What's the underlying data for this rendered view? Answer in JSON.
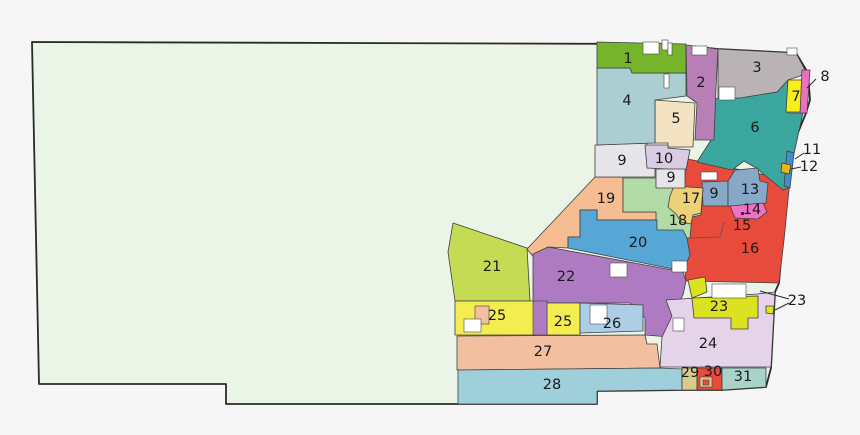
{
  "figure": {
    "width": 860,
    "height": 435,
    "background": "#f6f6f6"
  },
  "map": {
    "type": "choropleth-district-map",
    "district_stroke": "#3f3f3f",
    "label_color": "#1a1a1a",
    "white_fill": "#ffffff",
    "label_font_size": 14.5,
    "callout_font_size": 14.5,
    "base_region": {
      "fill": "#ebf5e7",
      "stroke": "#2a2a2a",
      "points": "32,42 660,44 688,46 718,49 796,53 808,73 810,100 806,113 795,140 790,172 788,190 783,235 779,283 775,292 771,368 766,387 722,390 682,390 597,391 597,404 226,404 226,384 39,384"
    },
    "districts": [
      {
        "num": "16",
        "color": "#e84b3c",
        "points": "683,158 790,180 784,240 779,283 686,281 683,250 688,224 681,192"
      },
      {
        "num": "6",
        "color": "#3aa69e",
        "points": "713,99 777,92 788,80 788,113 803,113 797,140 790,172 788,188 783,190 756,168 744,161 732,170 697,162 711,140"
      },
      {
        "num": "9",
        "color": "#87a9c7",
        "points": "702,182 728,181 728,206 703,206"
      },
      {
        "num": "13",
        "color": "#87a9c7",
        "points": "728,181 735,170 758,168 760,181 768,183 766,203 744,208 728,206"
      },
      {
        "num": "14",
        "color": "#f171c5",
        "points": "730,206 763,203 767,212 758,219 735,218"
      },
      {
        "num": "19",
        "color": "#f6bc92",
        "points": "595,177 623,177 623,212 657,212 657,220 597,220 597,210 580,210 580,237 568,237 568,248 548,247 540,265 527,249"
      },
      {
        "num": "18",
        "color": "#b2dba8",
        "points": "623,178 672,178 672,188 680,186 703,189 701,215 692,217 690,238 656,238 656,212 623,212"
      },
      {
        "num": "17",
        "color": "#edd179",
        "points": "674,186 703,188 701,213 693,215 691,224 681,222 676,214 668,207 670,196"
      },
      {
        "num": "9",
        "color": "#e7e5e9",
        "points": "595,145 647,143 647,168 655,168 655,177 595,177"
      },
      {
        "num": "5",
        "color": "#f3e3c3",
        "points": "655,100 695,103 693,147 668,147 668,143 655,143"
      },
      {
        "num": "10",
        "color": "#d8cbe2",
        "points": "645,145 668,145 668,148 690,150 686,170 647,168"
      },
      {
        "num": "9",
        "color": "#e7e5e9",
        "points": "656,169 685,169 685,188 656,188"
      },
      {
        "num": "4",
        "color": "#abced3",
        "points": "597,68 630,68 632,73 686,73 686,96 655,100 655,143 597,145"
      },
      {
        "num": "1",
        "color": "#76b42c",
        "points": "597,42 686,44 686,73 632,73 630,68 597,68"
      },
      {
        "num": "2",
        "color": "#b77fb5",
        "points": "686,45 718,49 716,88 714,140 695,140 697,103 687,96"
      },
      {
        "num": "3",
        "color": "#b9b3b5",
        "points": "718,49 796,53 806,72 800,76 788,80 777,92 740,98 718,98"
      },
      {
        "num": "7",
        "color": "#f8ef16",
        "points": "788,80 803,80 801,112 786,112"
      },
      {
        "num": "8",
        "color": "#ec6fc0",
        "points": "802,70 810,70 807,113 800,113"
      },
      {
        "num": "11",
        "color": "#3e8ecb",
        "points": "787,151 794,153 790,188 784,186"
      },
      {
        "num": "12",
        "color": "#f0b513",
        "points": "782,163 791,165 789,174 781,172"
      },
      {
        "num": "20",
        "color": "#56a6d6",
        "points": "580,210 597,210 597,220 657,220 657,230 683,230 687,238 690,255 683,271 568,248 568,237 580,237"
      },
      {
        "num": "22",
        "color": "#ae7bc3",
        "points": "548,247 683,272 686,281 683,295 672,316 670,337 645,335 645,318 630,303 533,303 533,254"
      },
      {
        "num": "21",
        "color": "#c5db54",
        "points": "453,223 527,248 530,301 455,301 448,252"
      },
      {
        "num": "24",
        "color": "#e5d3e9",
        "points": "666,300 757,294 775,292 771,367 660,367 662,337 672,316"
      },
      {
        "num": "23",
        "color": "#dce21f",
        "points": "688,280 705,277 707,292 692,298"
      },
      {
        "num": "23",
        "color": "#dce21f",
        "points": "692,298 758,296 758,318 748,318 748,329 731,329 731,318 694,318"
      },
      {
        "num": "23",
        "color": "#dce21f",
        "points": "766,306 774,306 773,314 766,313"
      },
      {
        "num": "25",
        "color": "#f4ed50",
        "points": "455,301 535,301 535,335 455,335"
      },
      {
        "num": "25",
        "color": "#f4ed50",
        "points": "547,303 580,303 580,335 547,335"
      },
      {
        "num": "26",
        "color": "#accfe7",
        "points": "580,303 643,305 643,331 580,333"
      },
      {
        "num": "27",
        "color": "#f2c0a0",
        "points": "457,336 645,335 647,344 657,344 660,368 457,370"
      },
      {
        "num": "28",
        "color": "#9ecfda",
        "points": "458,370 660,368 682,369 682,390 597,391 597,404 458,404"
      },
      {
        "num": "29",
        "color": "#d8cc8d",
        "points": "682,368 697,368 697,390 682,390"
      },
      {
        "num": "30",
        "color": "#e84b3c",
        "points": "697,368 722,368 722,390 697,390"
      },
      {
        "num": "31",
        "color": "#a8d3c8",
        "points": "722,368 766,368 766,387 722,390"
      }
    ],
    "color_patches": [
      {
        "x": 475,
        "y": 306,
        "w": 14,
        "h": 18,
        "color": "#f2c0a0"
      },
      {
        "x": 533,
        "y": 301,
        "w": 14,
        "h": 34,
        "color": "#ae7bc3"
      },
      {
        "x": 700,
        "y": 377,
        "w": 12,
        "h": 10,
        "color": "#d8cc8d"
      },
      {
        "x": 703,
        "y": 380,
        "w": 6,
        "h": 5,
        "color": "#e84b3c"
      }
    ],
    "white_patches": [
      {
        "x": 643,
        "y": 42,
        "w": 16,
        "h": 12
      },
      {
        "x": 662,
        "y": 40,
        "w": 6,
        "h": 10
      },
      {
        "x": 668,
        "y": 43,
        "w": 4,
        "h": 12
      },
      {
        "x": 692,
        "y": 46,
        "w": 15,
        "h": 9
      },
      {
        "x": 664,
        "y": 74,
        "w": 5,
        "h": 14
      },
      {
        "x": 719,
        "y": 87,
        "w": 16,
        "h": 13
      },
      {
        "x": 787,
        "y": 48,
        "w": 10,
        "h": 7
      },
      {
        "x": 701,
        "y": 172,
        "w": 16,
        "h": 8
      },
      {
        "x": 610,
        "y": 263,
        "w": 17,
        "h": 14
      },
      {
        "x": 672,
        "y": 261,
        "w": 15,
        "h": 11
      },
      {
        "x": 712,
        "y": 284,
        "w": 34,
        "h": 14
      },
      {
        "x": 673,
        "y": 318,
        "w": 11,
        "h": 13
      },
      {
        "x": 464,
        "y": 319,
        "w": 17,
        "h": 13
      },
      {
        "x": 590,
        "y": 305,
        "w": 17,
        "h": 19
      }
    ],
    "boundary_lines": [
      {
        "points": "688,238 720,237 724,222"
      }
    ],
    "marker_dot": {
      "x": 741,
      "y": 212,
      "size": 3
    },
    "labels": [
      {
        "text": "1",
        "x": 628,
        "y": 59
      },
      {
        "text": "2",
        "x": 701,
        "y": 83
      },
      {
        "text": "3",
        "x": 757,
        "y": 68
      },
      {
        "text": "4",
        "x": 627,
        "y": 101
      },
      {
        "text": "5",
        "x": 676,
        "y": 119
      },
      {
        "text": "6",
        "x": 755,
        "y": 128
      },
      {
        "text": "7",
        "x": 796,
        "y": 97
      },
      {
        "text": "9",
        "x": 622,
        "y": 161
      },
      {
        "text": "10",
        "x": 664,
        "y": 159
      },
      {
        "text": "9",
        "x": 671,
        "y": 178
      },
      {
        "text": "9",
        "x": 714,
        "y": 194
      },
      {
        "text": "13",
        "x": 750,
        "y": 190
      },
      {
        "text": "14",
        "x": 752,
        "y": 210
      },
      {
        "text": "15",
        "x": 742,
        "y": 226
      },
      {
        "text": "16",
        "x": 750,
        "y": 249
      },
      {
        "text": "17",
        "x": 691,
        "y": 199
      },
      {
        "text": "18",
        "x": 678,
        "y": 221
      },
      {
        "text": "19",
        "x": 606,
        "y": 199
      },
      {
        "text": "20",
        "x": 638,
        "y": 243
      },
      {
        "text": "21",
        "x": 492,
        "y": 267
      },
      {
        "text": "22",
        "x": 566,
        "y": 277
      },
      {
        "text": "23",
        "x": 719,
        "y": 307
      },
      {
        "text": "24",
        "x": 708,
        "y": 344
      },
      {
        "text": "25",
        "x": 497,
        "y": 316
      },
      {
        "text": "25",
        "x": 563,
        "y": 322
      },
      {
        "text": "26",
        "x": 612,
        "y": 324
      },
      {
        "text": "27",
        "x": 543,
        "y": 352
      },
      {
        "text": "28",
        "x": 552,
        "y": 385
      },
      {
        "text": "29",
        "x": 690,
        "y": 373
      },
      {
        "text": "30",
        "x": 713,
        "y": 372
      },
      {
        "text": "31",
        "x": 743,
        "y": 377
      }
    ],
    "callouts": [
      {
        "text": "8",
        "x": 825,
        "y": 77,
        "lines": [
          {
            "x1": 816,
            "y1": 79,
            "x2": 807,
            "y2": 88
          }
        ]
      },
      {
        "text": "11",
        "x": 812,
        "y": 150,
        "lines": [
          {
            "x1": 804,
            "y1": 153,
            "x2": 795,
            "y2": 159
          }
        ]
      },
      {
        "text": "12",
        "x": 809,
        "y": 167,
        "lines": [
          {
            "x1": 801,
            "y1": 167,
            "x2": 791,
            "y2": 169
          }
        ]
      },
      {
        "text": "23",
        "x": 797,
        "y": 301,
        "lines": [
          {
            "x1": 789,
            "y1": 299,
            "x2": 760,
            "y2": 291
          },
          {
            "x1": 789,
            "y1": 303,
            "x2": 775,
            "y2": 310
          }
        ]
      }
    ]
  }
}
